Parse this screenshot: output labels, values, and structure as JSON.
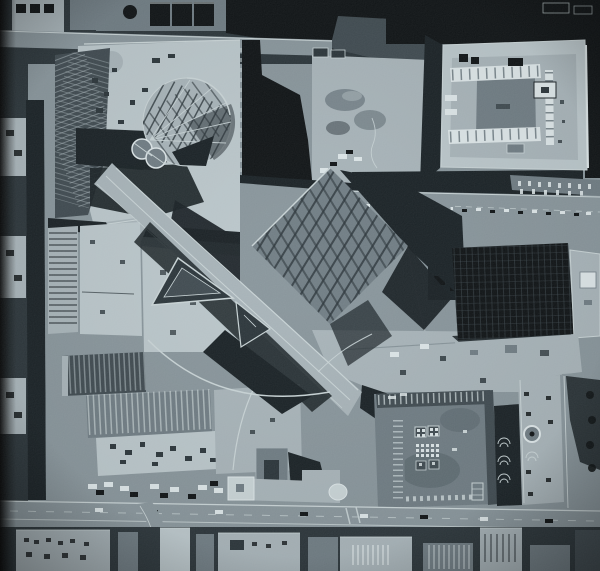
{
  "meta": {
    "medium": "halftone book reproduction of a black-and-white aerial photograph",
    "view": "vertical straight-down aerial view of several downtown city blocks",
    "tone": "cool blue-gray monochrome"
  },
  "palette": {
    "ink": "#0b0f11",
    "shadow": "#161e22",
    "dark": "#283237",
    "graydark": "#3d484e",
    "mid": "#6e7b82",
    "street": "#87949a",
    "light": "#a7b3b8",
    "lighter": "#bac6ca",
    "offwhite": "#c9d4d6",
    "white": "#dde6e8"
  },
  "scene": {
    "summary": "Overhead aerial photograph of a downtown construction site spanning several city blocks. A cleared concrete block at the upper left holds a circular steel dome framework, two round tanks and dark steel lattice framing. A light diagonal spine with parallel white edge lines and triangular pavilion frames runs from the upper left toward the lower center, passing a square steel frame rotated 45 degrees. A large flat-roofed building with an inner courtyard and white parapet rows sits at the upper right; a dark gridded high-rise roof sits at the middle right. The lower half shows ribbed warehouse roofs, a truck yard, a square building with white skylight dot grids, a narrow landscaped strip with a circular fountain, and a wide boulevard with traffic crossing near the bottom, lined with small commercial rooftops.",
    "regions": [
      {
        "name": "page-gutter",
        "desc": "dark printed page edge along the far left"
      },
      {
        "name": "top-blocks",
        "desc": "row of dark rooftops, gabled houses and tree shadows along the top edge with a narrow cross street"
      },
      {
        "name": "courtyard-building",
        "desc": "large light flat roof with rectangular inner courtyard, white parapet skylight rows, rooftop vents and a penthouse box (top right)"
      },
      {
        "name": "construction-site",
        "desc": "cleared light concrete block with equipment, crane shadows and a white boundary fence (upper left)"
      },
      {
        "name": "dome-frame",
        "desc": "circular geodesic steel dome framework under construction"
      },
      {
        "name": "storage-tanks",
        "desc": "two round tanks with bright rims beside the dome"
      },
      {
        "name": "steel-lattice-block",
        "desc": "dark rectangular steel framing grid on the west edge of the site"
      },
      {
        "name": "diamond-steel-frame",
        "desc": "square steel framing grid rotated 45 degrees at the center"
      },
      {
        "name": "diagonal-walkway",
        "desc": "light diagonal spine with parallel white edge lines, two triangular pavilion frames and a curved white access road"
      },
      {
        "name": "excavation-area",
        "desc": "graded dirt with spoil piles, sheds and small trucks (upper center)"
      },
      {
        "name": "broadway-street",
        "desc": "horizontal street with rows of parked cars above the dark tower (right)"
      },
      {
        "name": "dark-tower",
        "desc": "dark gridded high-rise roof with a lighter annex roof at its right edge (middle right)"
      },
      {
        "name": "west-streets",
        "desc": "vertical street, deep shadow band and small lots along the left edge"
      },
      {
        "name": "warehouse-block",
        "desc": "long ribbed warehouse roofs, rooftop equipment and a truck yard (lower left)"
      },
      {
        "name": "patterned-roof-building",
        "desc": "square roof with white skylight dot grids, hatched edge strips and vent dashes (bottom center)"
      },
      {
        "name": "linear-park",
        "desc": "narrow landscaped strip with circular fountain ring and scalloped planting beds (bottom right)"
      },
      {
        "name": "main-street",
        "desc": "wide boulevard crossing the bottom of the frame with cars, a crosswalk and a curved side street"
      },
      {
        "name": "bottom-buildings",
        "desc": "row of small flat-roofed commercial buildings with striped awnings along the bottom edge"
      }
    ]
  }
}
